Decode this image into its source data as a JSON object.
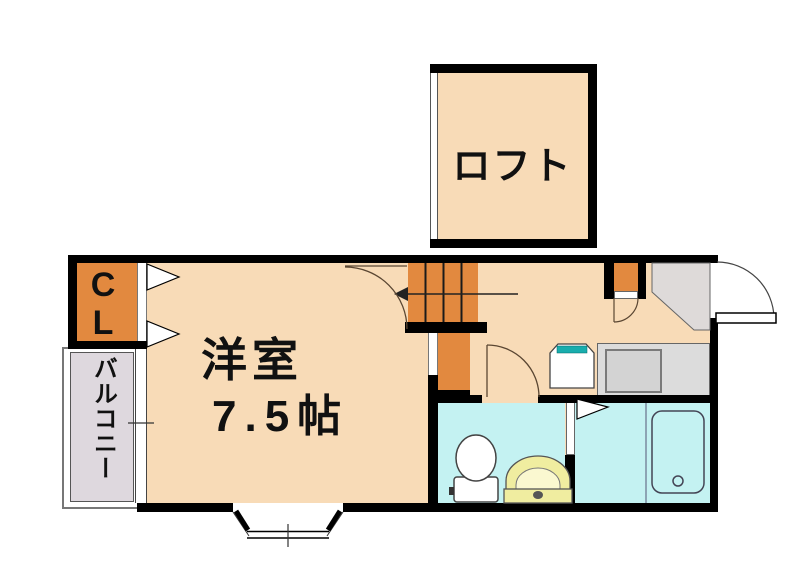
{
  "rooms": {
    "loft": {
      "label": "ロフト"
    },
    "main_room": {
      "label": "洋室",
      "size": "7.5帖"
    },
    "closet": {
      "label": "CL"
    },
    "balcony": {
      "label": "バルコニー"
    }
  },
  "colors": {
    "wall": "#000000",
    "room_floor": "#F8DBB7",
    "accent_orange": "#E2893F",
    "balcony_floor": "#DED8DE",
    "entry_floor": "#DEDAD9",
    "counter_gray": "#DCDCDC",
    "counter_inner": "#D3D3D3",
    "wet_floor": "#C4F2F2",
    "fixture_yellow": "#F0EDA0",
    "fixture_yellow_light": "#FAF8D0",
    "teal_accent": "#19ADAD"
  }
}
